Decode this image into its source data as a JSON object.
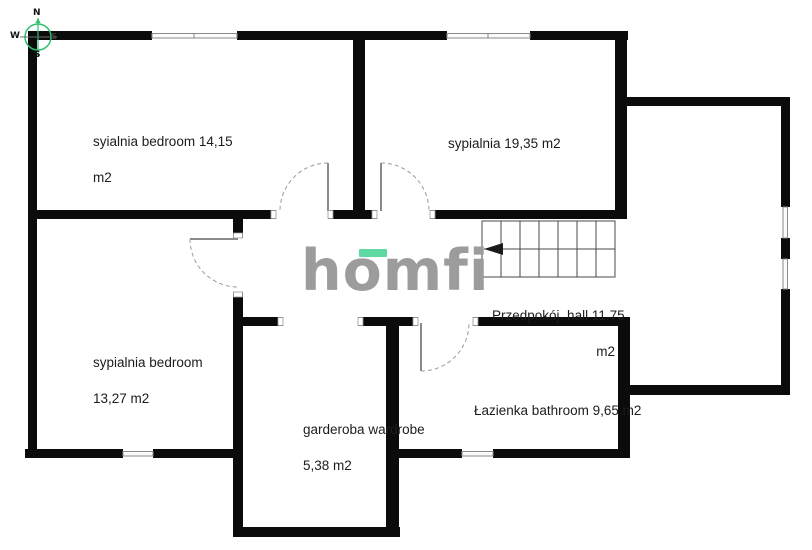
{
  "compass": {
    "north": "N",
    "south": "S",
    "west": "W",
    "east": "E"
  },
  "logo": {
    "pre": "h",
    "accent_letter": "o",
    "post": "mfi",
    "accent_color": "#5ed9a2",
    "text_color": "#9c9c9c"
  },
  "rooms": {
    "bedroom_top_left": {
      "line1": "syialnia bedroom 14,15",
      "line2": "m2"
    },
    "bedroom_top_mid": {
      "label": "sypialnia 19,35 m2"
    },
    "bedroom_bottom": {
      "line1": "sypialnia bedroom",
      "line2": "13,27 m2"
    },
    "wardrobe": {
      "line1": "garderoba wardrobe",
      "line2": "5,38 m2"
    },
    "hall": {
      "line1": "Przedpokój  hall 11,75",
      "line2": "m2"
    },
    "bathroom": {
      "label": "Łazienka bathroom 9,65 m2"
    }
  },
  "colors": {
    "wall": "#0b0b0b",
    "thin_line": "#4a4a4a",
    "door_arc": "#9a9a9a",
    "compass_green": "#2fbf71",
    "logo_gray": "#9c9c9c",
    "logo_green": "#5ed9a2"
  }
}
